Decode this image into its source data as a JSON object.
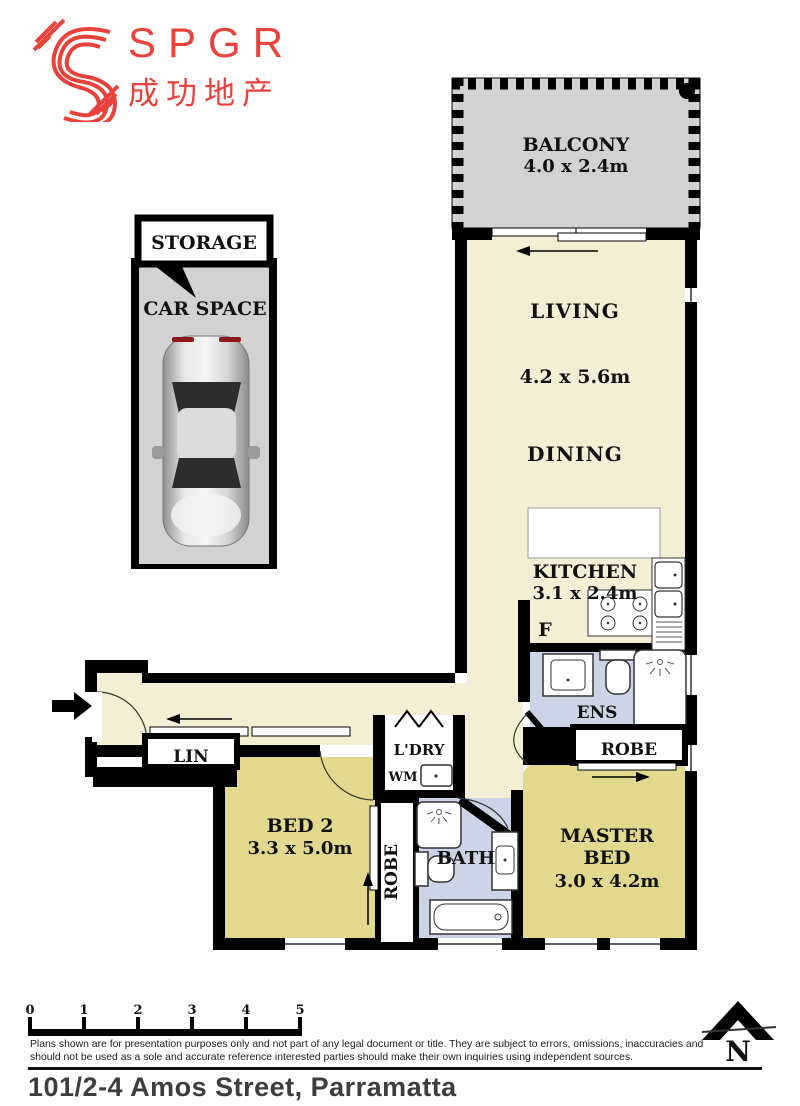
{
  "logo": {
    "brand": "SPGR",
    "chinese": "成功地产",
    "color": "#E8423A"
  },
  "plan": {
    "balcony": {
      "name": "BALCONY",
      "dims": "4.0 x 2.4m"
    },
    "living": {
      "name": "LIVING",
      "dims": "4.2 x 5.6m"
    },
    "dining": {
      "name": "DINING"
    },
    "kitchen": {
      "name": "KITCHEN",
      "dims": "3.1 x 2.4m"
    },
    "fridge": "F",
    "ens": "ENS",
    "robe_master": "ROBE",
    "master": {
      "line1": "MASTER",
      "line2": "BED",
      "dims": "3.0 x 4.2m"
    },
    "lin": "LIN",
    "bed2": {
      "name": "BED 2",
      "dims": "3.3 x 5.0m"
    },
    "robe_bed2": "ROBE",
    "laundry": "L'DRY",
    "wm": "WM",
    "bath": "BATH",
    "storage": "STORAGE",
    "car_space": "CAR SPACE"
  },
  "colors": {
    "wall": "#000000",
    "cream": "#F3EFD4",
    "khaki": "#E3D98E",
    "wet_area_blue": "#CDD4E8",
    "balcony_gray": "#D2D2D2",
    "logo_red": "#E8423A"
  },
  "scale_bar": {
    "ticks": [
      "0",
      "1",
      "2",
      "3",
      "4",
      "5"
    ]
  },
  "footer": {
    "disclaimer_line1": "Plans shown are for presentation purposes only and not part of any legal document or title. They are subject to errors, omissions, inaccuracies and",
    "disclaimer_line2": "should not be used as a sole and accurate reference interested parties should make their own inquiries using independent sources.",
    "address": "101/2-4 Amos Street, Parramatta",
    "north": "N"
  }
}
